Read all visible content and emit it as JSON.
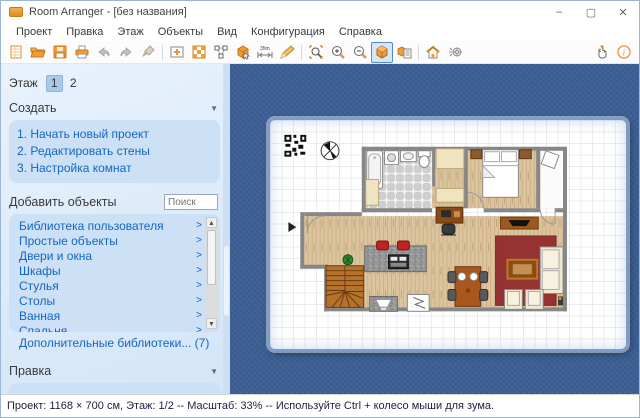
{
  "window": {
    "title": "Room Arranger - [без названия]",
    "controls": {
      "minimize": "–",
      "maximize": "▢",
      "close": "✕"
    }
  },
  "menu": {
    "items": [
      "Проект",
      "Правка",
      "Этаж",
      "Объекты",
      "Вид",
      "Конфигурация",
      "Справка"
    ]
  },
  "toolbar": {
    "icons": [
      "new-document",
      "open-folder",
      "save",
      "print",
      "undo",
      "redo",
      "format-brush",
      "edit-walls",
      "tiles",
      "edit-points",
      "insert-object",
      "measure",
      "draw",
      "zoom-region",
      "zoom-in",
      "zoom-out",
      "view-3d",
      "object-list",
      "walkthrough",
      "render",
      "pan-hand",
      "info"
    ],
    "active_icon": "view-3d",
    "measure_label": "35m"
  },
  "sidebar": {
    "floor_label": "Этаж",
    "floors": [
      "1",
      "2"
    ],
    "active_floor": "1",
    "create": {
      "title": "Создать",
      "items": [
        "1. Начать новый проект",
        "2. Редактировать стены",
        "3. Настройка комнат"
      ]
    },
    "add_objects": {
      "title": "Добавить объекты",
      "search_placeholder": "Поиск",
      "categories": [
        "Библиотека пользователя",
        "Простые объекты",
        "Двери и окна",
        "Шкафы",
        "Стулья",
        "Столы",
        "Ванная",
        "Спальня"
      ],
      "more_libraries": "Дополнительные библиотеки... (7)"
    },
    "edit": {
      "title": "Правка"
    }
  },
  "floor_plan": {
    "objects": [
      "qr-code",
      "compass",
      "bathtub",
      "washing-machine",
      "sink",
      "toilet",
      "closet",
      "bed",
      "nightstand",
      "balcony-table",
      "tv-stand",
      "desk",
      "desk-chair",
      "rug",
      "coffee-table",
      "sofa",
      "armchair",
      "kitchen-island",
      "stove",
      "bar-stool",
      "stairs",
      "plant",
      "sink-counter",
      "fridge",
      "dining-table",
      "dining-chair"
    ]
  },
  "statusbar": {
    "text": "Проект: 1168 × 700 см, Этаж: 1/2 -- Масштаб: 33% -- Используйте Ctrl + колесо мыши для зума."
  },
  "colors": {
    "canvas_blue": "#3d5f93",
    "accent_orange": "#e8913a",
    "link_blue": "#1565c0",
    "panel_blue": "#cde1f6",
    "rug_red": "#953232",
    "wood": "#d9c29c"
  }
}
